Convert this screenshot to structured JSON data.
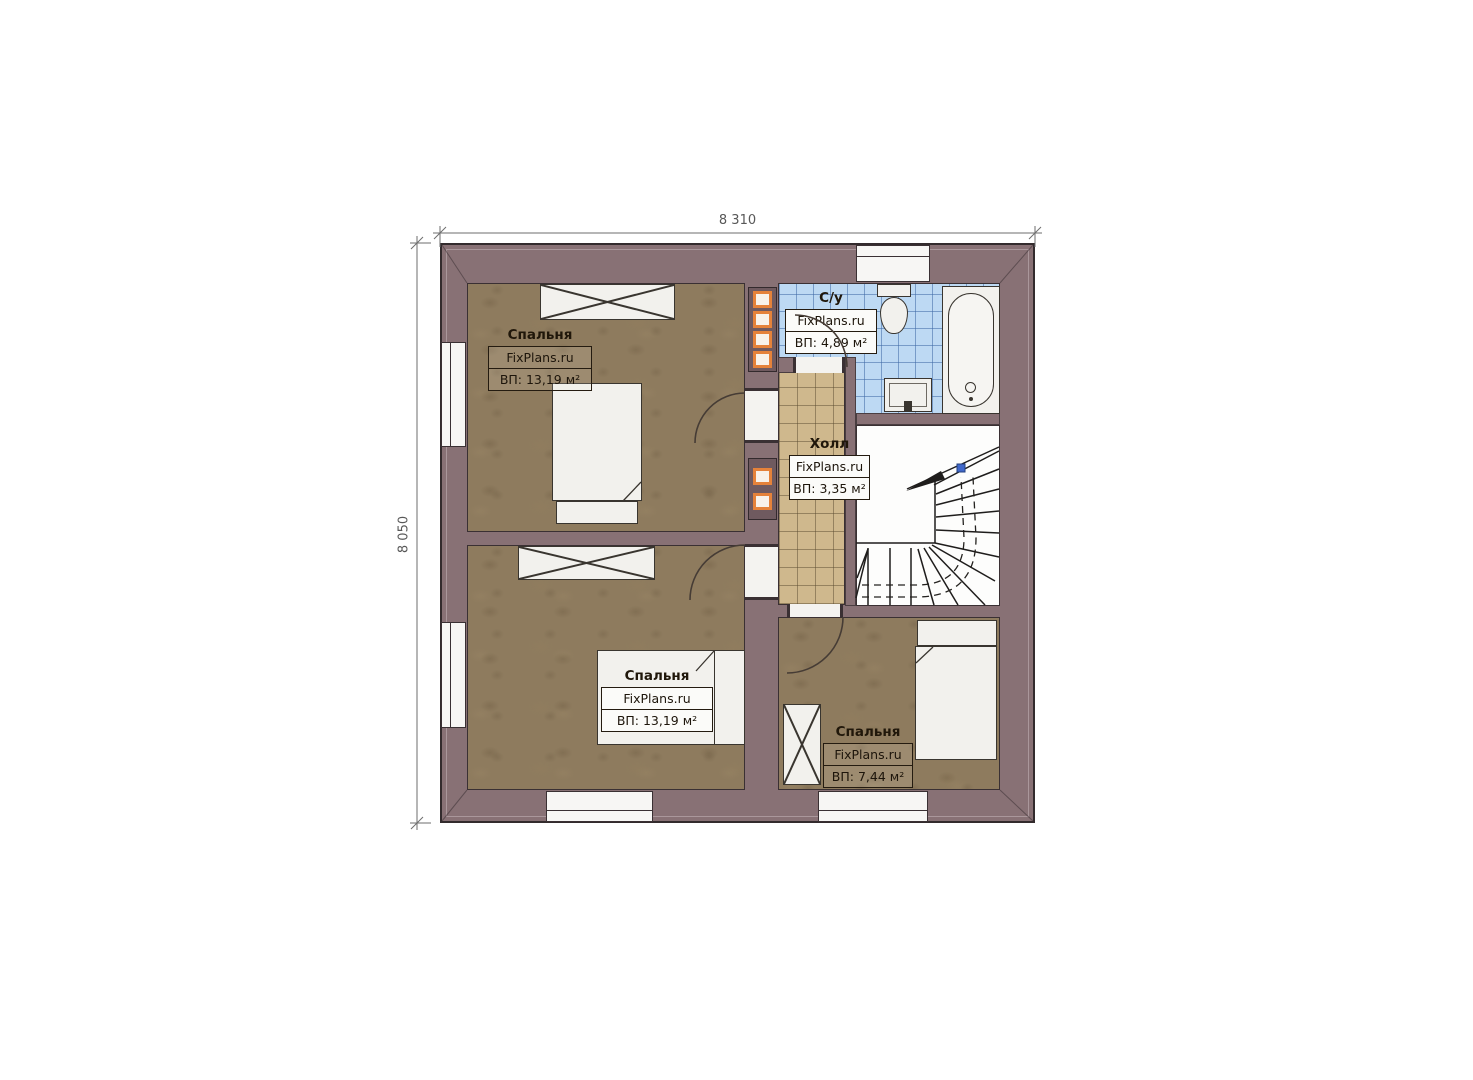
{
  "dimensions": {
    "top": "8 310",
    "left": "8 050"
  },
  "rooms": [
    {
      "key": "bedroom-top-left",
      "name": "Спальня",
      "brand": "FixPlans.ru",
      "area": "ВП: 13,19 м²"
    },
    {
      "key": "bathroom",
      "name": "С/у",
      "brand": "FixPlans.ru",
      "area": "ВП: 4,89 м²"
    },
    {
      "key": "hall",
      "name": "Холл",
      "brand": "FixPlans.ru",
      "area": "ВП: 3,35 м²"
    },
    {
      "key": "bedroom-bottom-left",
      "name": "Спальня",
      "brand": "FixPlans.ru",
      "area": "ВП: 13,19 м²"
    },
    {
      "key": "bedroom-bottom-right",
      "name": "Спальня",
      "brand": "FixPlans.ru",
      "area": "ВП: 7,44 м²"
    }
  ],
  "colors": {
    "wall": "#887175",
    "outline": "#3a3033",
    "bedroom_floor": "#8e7b5e",
    "hall_floor": "#cfb88d",
    "bathroom_floor": "#bdd9f3",
    "stairs_floor": "#fdfdfc",
    "flue_accent": "#e5823a",
    "walkline_marker": "#4067c9",
    "dimension_text": "#585858"
  }
}
